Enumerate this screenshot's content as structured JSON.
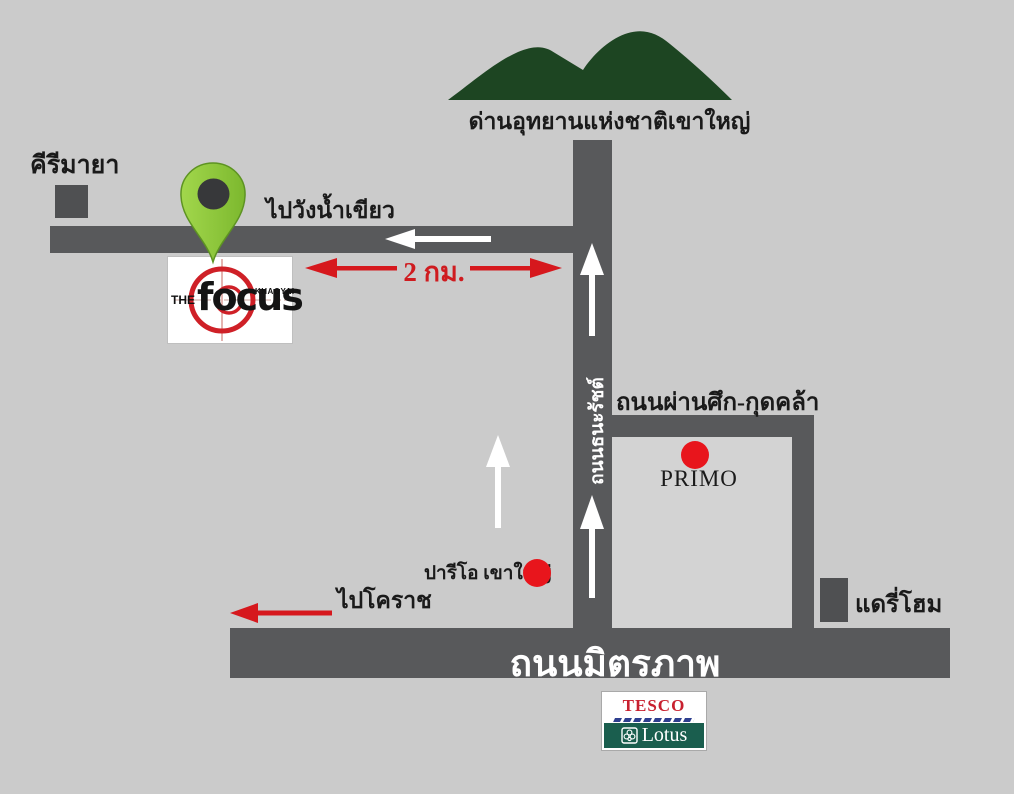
{
  "colors": {
    "background": "#cbcbcb",
    "road_fill": "#58595b",
    "road_text": "#ffffff",
    "arrow_white": "#ffffff",
    "arrow_red": "#d6181d",
    "mountain_green": "#1d4522",
    "pin_green": "#8dc63f",
    "landmark_square": "#4f5052",
    "focus_red": "#cf2027",
    "tesco_red": "#c8202f",
    "tesco_blue": "#2e3f8f",
    "lotus_green": "#1a5e4e"
  },
  "landmarks": {
    "national_park": {
      "label": "ด่านอุทยานแห่งชาติเขาใหญ่"
    },
    "kirimaya": {
      "label": "คีรีมายา"
    },
    "focus_logo": {
      "the": "THE",
      "name": "focus",
      "sub": "KHAOYAI"
    },
    "primo": {
      "label": "PRIMO"
    },
    "palio": {
      "label": "ปารีโอ เขาใหญ่"
    },
    "dairy_home": {
      "label": "แดรี่โฮม"
    },
    "tesco_lotus": {
      "line1": "TESCO",
      "line2": "Lotus"
    }
  },
  "roads": {
    "thanarat": {
      "label": "ถนนธนะรัชต์"
    },
    "phan_suek": {
      "label": "ถนนผ่านศึก-กุดคล้า"
    },
    "mittraphap": {
      "label": "ถนนมิตรภาพ"
    }
  },
  "directions": {
    "to_wang_nam_khiao": {
      "label": "ไปวังน้ำเขียว"
    },
    "to_korat": {
      "label": "ไปโคราช"
    },
    "distance": {
      "label": "2 กม."
    }
  }
}
